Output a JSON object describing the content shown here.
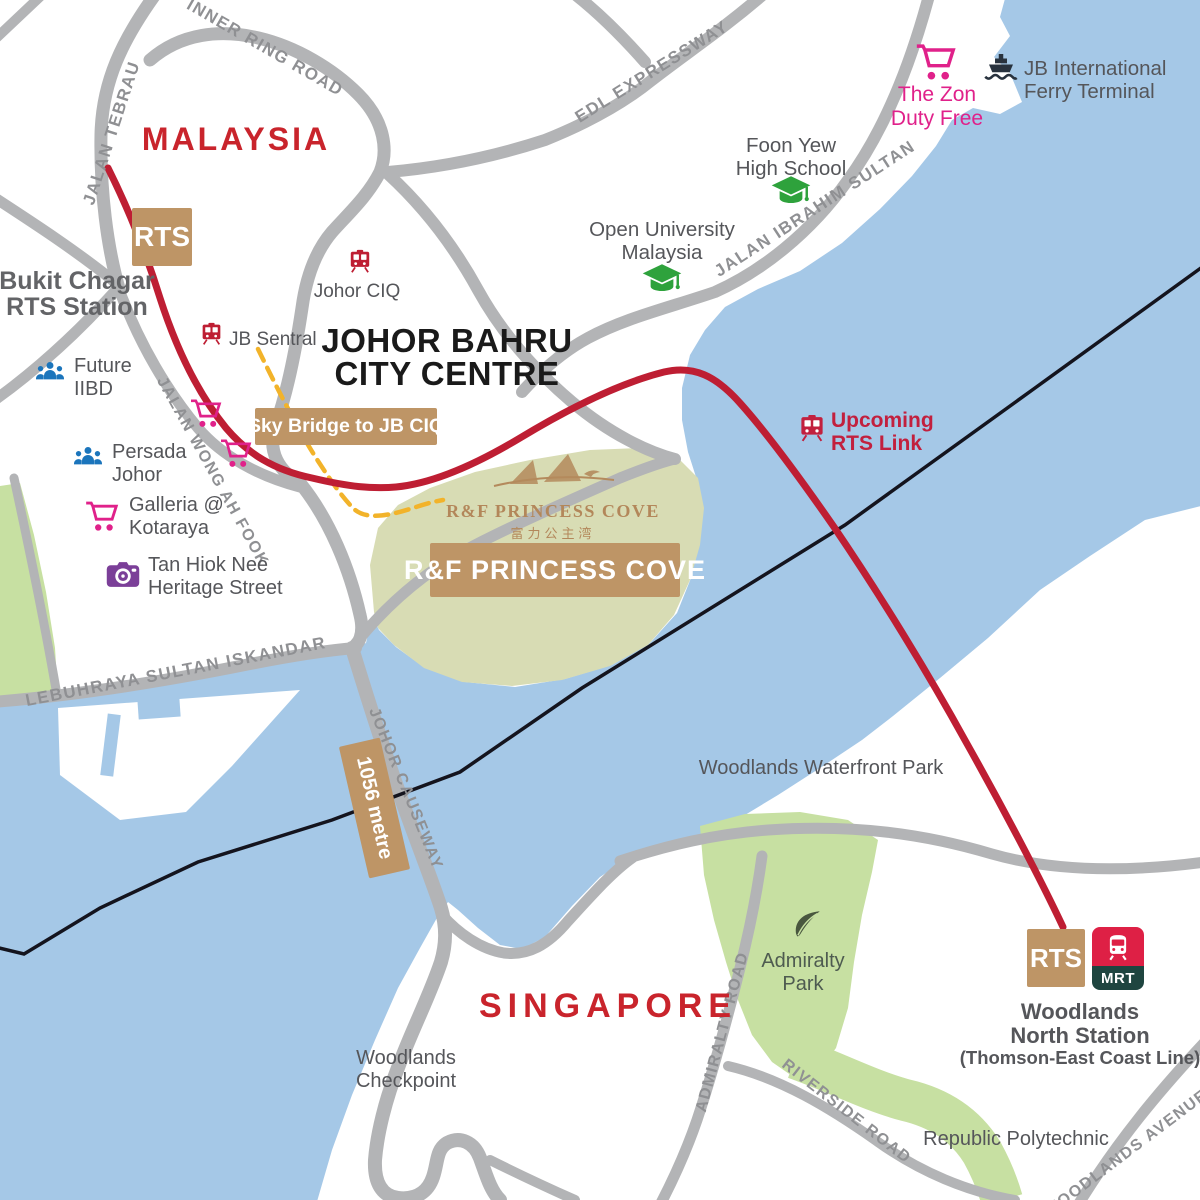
{
  "colors": {
    "water": "#A5C8E7",
    "land": "#FFFFFF",
    "road": "#B3B4B6",
    "park": "#C7E0A2",
    "rf-park": "#D8DCB4",
    "road-label": "#8F9093",
    "poi-label": "#55565A",
    "rts-red": "#BE1E33",
    "tan": "#BE9566",
    "country-red": "#C9242C",
    "magenta": "#E0218A",
    "blue-icon": "#1B75BC",
    "purple-icon": "#7B3F98",
    "green-icon": "#2EA23C",
    "leaf-green": "#49573F",
    "navy-icon": "#28323E",
    "border-line": "#14141E",
    "sky-bridge-yellow": "#F2B32A",
    "mrt-red": "#DE2045",
    "mrt-band": "#1F4540",
    "crimson-text": "#C2203E",
    "black-text": "#1A1A1A"
  },
  "countries": {
    "malaysia": "MALAYSIA",
    "singapore": "SINGAPORE"
  },
  "city": {
    "line1": "JOHOR BAHRU",
    "line2": "CITY CENTRE"
  },
  "roads": {
    "inner_ring": "INNER RING ROAD",
    "jalan_tebrau": "JALAN TEBRAU",
    "edl": "EDL EXPRESSWAY",
    "ibrahim": "JALAN IBRAHIM SULTAN",
    "wong_ah_fook": "JALAN WONG AH FOOK",
    "lebuhraya": "LEBUHRAYA SULTAN ISKANDAR",
    "causeway": "JOHOR CAUSEWAY",
    "admiralty": "ADMIRALTY ROAD",
    "riverside": "RIVERSIDE ROAD",
    "woodlands_ave": "WOODLANDS AVENUE 9"
  },
  "badges": {
    "rts": "RTS",
    "sky_bridge": "Sky Bridge to JB CIQ",
    "rf_box": "R&F PRINCESS COVE",
    "causeway_length": "1056 metre",
    "mrt": "MRT"
  },
  "pois": {
    "bukit_chagar": {
      "l1": "Bukit Chagar",
      "l2": "RTS Station"
    },
    "johor_ciq": "Johor CIQ",
    "jb_sentral": "JB Sentral",
    "future_iibd": {
      "l1": "Future",
      "l2": "IIBD"
    },
    "persada": {
      "l1": "Persada",
      "l2": "Johor"
    },
    "galleria": {
      "l1": "Galleria @",
      "l2": "Kotaraya"
    },
    "tan_hiok_nee": {
      "l1": "Tan Hiok Nee",
      "l2": "Heritage Street"
    },
    "the_zon": {
      "l1": "The Zon",
      "l2": "Duty Free"
    },
    "ferry": {
      "l1": "JB International",
      "l2": "Ferry Terminal"
    },
    "foon_yew": {
      "l1": "Foon Yew",
      "l2": "High School"
    },
    "open_uni": {
      "l1": "Open University",
      "l2": "Malaysia"
    },
    "upcoming": {
      "l1": "Upcoming",
      "l2": "RTS Link"
    },
    "waterfront": "Woodlands Waterfront Park",
    "admiralty_park": {
      "l1": "Admiralty",
      "l2": "Park"
    },
    "checkpoint": {
      "l1": "Woodlands",
      "l2": "Checkpoint"
    },
    "republic": "Republic Polytechnic",
    "woodlands_north": {
      "l1": "Woodlands",
      "l2": "North Station",
      "l3": "(Thomson-East Coast Line)"
    },
    "rf_logo": {
      "name": "R&F PRINCESS COVE",
      "chinese": "富力公主湾"
    }
  }
}
